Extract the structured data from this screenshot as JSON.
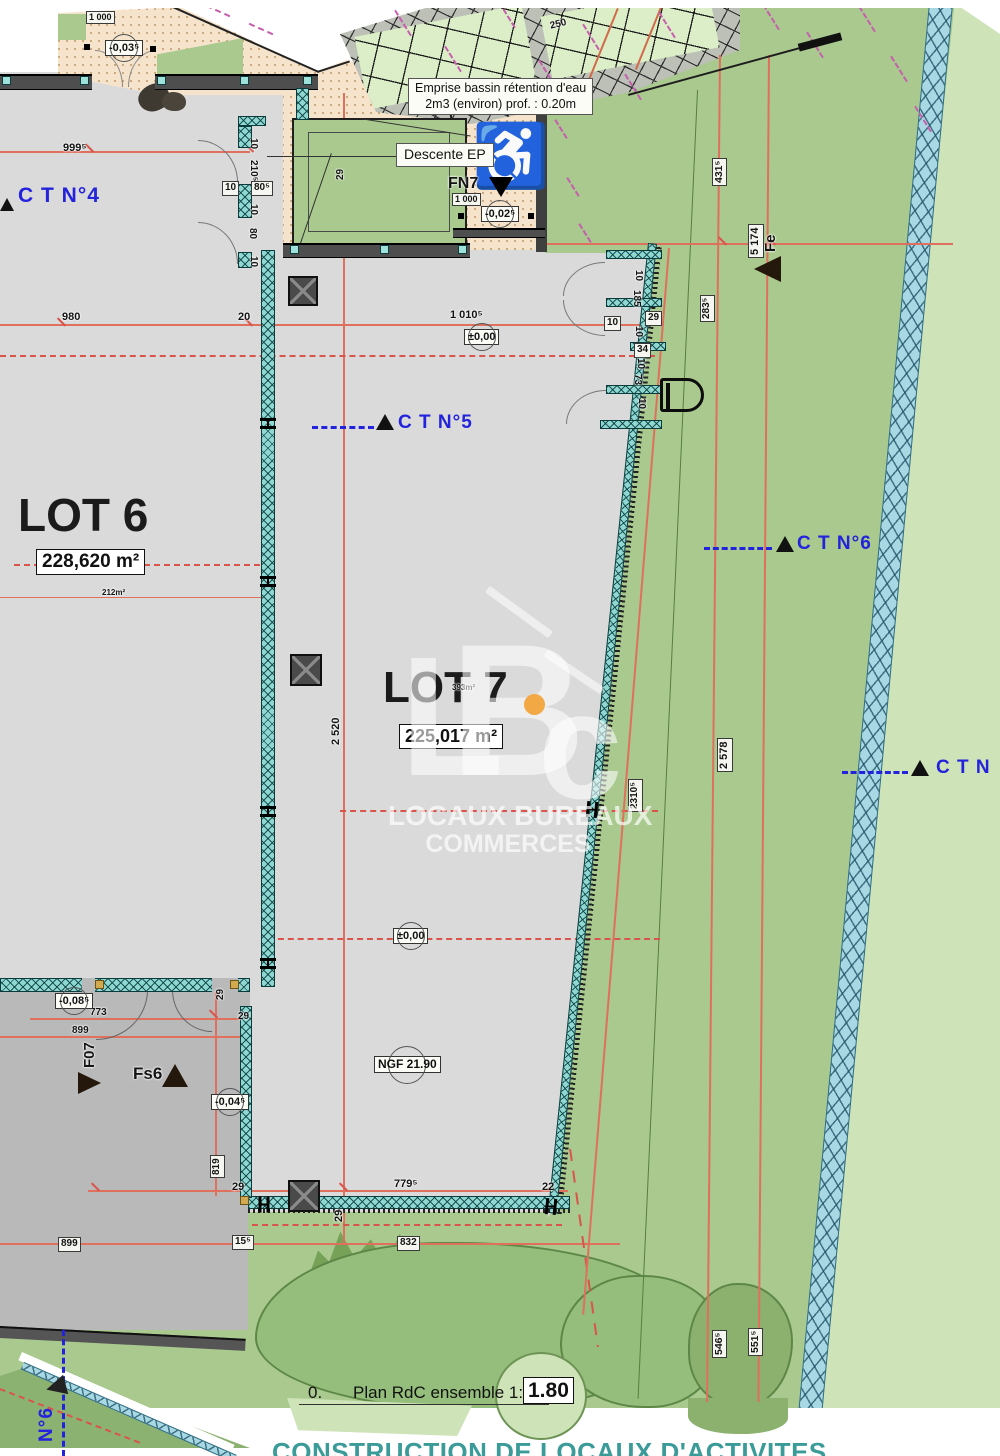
{
  "title_block": {
    "caption_number": "0.",
    "caption": "Plan RdC ensemble 1:100",
    "level_box": "1.80",
    "project_title": "CONSTRUCTION DE LOCAUX D'ACTIVITES"
  },
  "lots": {
    "lot6": {
      "name": "LOT 6",
      "area": "228,620 m²",
      "sub_area": "212m²"
    },
    "lot7": {
      "name": "LOT 7",
      "area": "225,017 m²",
      "sub_area": "393m²"
    }
  },
  "annotations": {
    "emprise_line1": "Emprise bassin rétention d'eau",
    "emprise_line2": "2m3 (environ) prof. :  0.20m",
    "descente_ep": "Descente EP",
    "ngf": "NGF 21.90"
  },
  "survey_markers": {
    "ct4": "C T N°4",
    "ct5": "C T N°5",
    "ct6": "C T N°6",
    "ct_right": "C T N",
    "n6": "N°6",
    "fn7": "FN7",
    "fe": "Fe",
    "f07": "F07",
    "fs6": "Fs6"
  },
  "levels": {
    "zero": "±0,00",
    "m003": "-0,03⁵",
    "m002": "-0,02⁵",
    "m008": "-0,08⁵",
    "m004": "-0,04⁵"
  },
  "dims": {
    "d999": "999⁵",
    "d980": "980",
    "d20": "20",
    "d1010": "1 010⁵",
    "d1000": "1 000",
    "d2520": "2 520",
    "d2578": "2 578",
    "d2310": "2310⁵",
    "d5174": "5 174",
    "d431": "431⁵",
    "d546": "546⁵",
    "d551": "551⁵",
    "d283": "283⁵",
    "d773": "773",
    "d899": "899",
    "d819": "819",
    "d779": "779⁵",
    "d832": "832",
    "d22": "22",
    "d29": "29",
    "d15": "15⁵",
    "d185": "185",
    "d34": "34",
    "d73": "73",
    "d80": "80",
    "d80s": "80⁵",
    "d210": "210⁵",
    "d10": "10",
    "d250": "250"
  },
  "watermark": {
    "letter_l": "L",
    "letter_b": "B",
    "letter_c": "c",
    "line1": "LOCAUX BUREAUX",
    "line2": "COMMERCES",
    "dot_color": "#f2a33c"
  },
  "colors": {
    "green": "#a9c98f",
    "pale_green": "#cfe3b8",
    "dark_green": "#8cb271",
    "building_gray": "#dadada",
    "dark_building_gray": "#b9b9b9",
    "beige": "#f6e3cb",
    "teal_wall": "#8ed7d2",
    "blue_strip": "#a8d8e4",
    "red_line": "#e0705e",
    "blue_marker": "#2323dd",
    "title_teal": "#3a9b99"
  }
}
